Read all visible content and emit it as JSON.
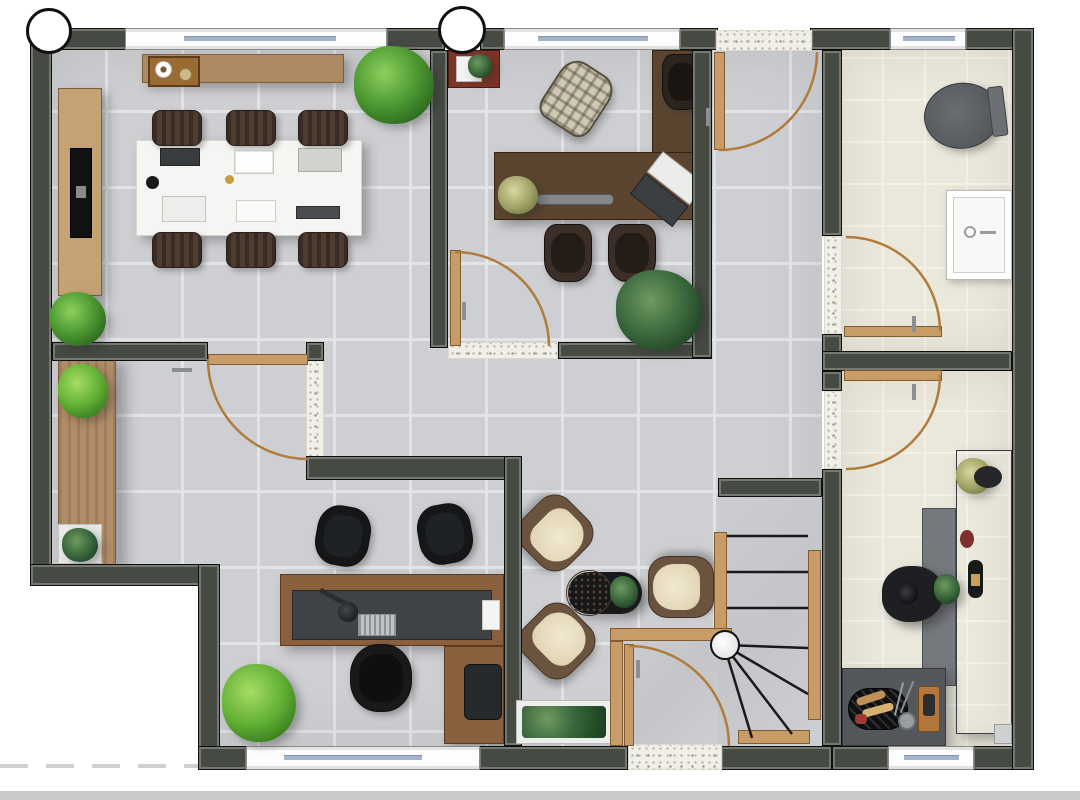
{
  "document": {
    "type": "architectural-floor-plan",
    "view": "top-down-rendered-3d",
    "width_px": 1080,
    "height_px": 800,
    "visible_text": "none"
  },
  "palette": {
    "wall": "#454a42",
    "wall_outline": "#0e100e",
    "gray_tile": "#cdcfd2",
    "gray_grout": "#e2e4e6",
    "beige_tile": "#eae7db",
    "concrete_stair": "#c8cacd",
    "threshold_speckle": "#f0efe8",
    "door_wood": "#c79c66",
    "door_arc": "#b07b3b",
    "bench_wood": "#b08d68",
    "conference_table": "#f5f5f3",
    "chair_brown": "#4f3c31",
    "chair_black": "#1a1c1e",
    "lounge_cream": "#e9dfc6",
    "lounge_frame": "#6b543f",
    "counter_dark": "#5a5e62",
    "toilet_gray": "#5b5f63",
    "fixture_white": "#f7f7f7",
    "plant_green": "#4e9a33",
    "plant_dark_green": "#2f5a33",
    "window_glass": "#a3b4ca",
    "grid_bubble_fill": "#ffffff"
  },
  "rooms": [
    {
      "id": "conference-room",
      "position": "north-west",
      "floor": "gray-tile",
      "furniture": [
        "wood sideboard with coffee tray",
        "wall tv console with tv",
        "white conference table",
        "six dark brown chairs",
        "laptops notebooks and papers on table",
        "corner potted plant",
        "corner ficus tree"
      ]
    },
    {
      "id": "executive-office",
      "position": "north-center",
      "floor": "gray-tile",
      "furniture": [
        "dark wood l-shaped desk",
        "desk speaker bar",
        "open laptop",
        "desk plant",
        "black executive chair",
        "rattan lounge chair",
        "two dark guest chairs",
        "monstera plant",
        "red side cabinet with plant"
      ]
    },
    {
      "id": "corridor",
      "position": "north-east-of-office",
      "floor": "gray-tile",
      "furniture": [
        "swing door at north speckled threshold"
      ]
    },
    {
      "id": "bathroom",
      "position": "north-east",
      "floor": "beige-tile",
      "furniture": [
        "gray toilet",
        "white washbasin with faucet"
      ]
    },
    {
      "id": "kitchen",
      "position": "east",
      "floor": "beige-tile",
      "furniture": [
        "l-shaped dark counter",
        "tall island counter",
        "person preparing food",
        "grill tray with food",
        "wooden cutting board",
        "flower bouquet",
        "bottle",
        "small pot"
      ]
    },
    {
      "id": "hallway",
      "position": "center",
      "floor": "gray-tile",
      "furniture": [
        "wooden bench along west wall",
        "potted plant on bench",
        "potted plant in white pot",
        "potted plant near office"
      ]
    },
    {
      "id": "lounge",
      "position": "center-south",
      "floor": "gray-tile",
      "furniture": [
        "three cream armchairs",
        "black oval coffee table",
        "round mosaic tray",
        "small table plant"
      ]
    },
    {
      "id": "office",
      "position": "south-west",
      "floor": "gray-tile",
      "furniture": [
        "l-shaped desk dark top wood frame",
        "desk lamp",
        "keyboard",
        "white document",
        "black office chair",
        "two black guest chairs",
        "dark file cabinet",
        "white planter box with greenery",
        "potted plant"
      ]
    },
    {
      "id": "staircase",
      "position": "south-center",
      "floor": "concrete",
      "furniture": [
        "three straight treads",
        "winder treads fanning from newel",
        "white newel circle",
        "timber stringers",
        "timber bottom tread"
      ]
    },
    {
      "id": "entry-vestibule",
      "position": "south",
      "floor": "concrete",
      "furniture": [
        "entry swing door",
        "speckled threshold",
        "timber corner trim"
      ]
    }
  ],
  "openings": {
    "windows": [
      {
        "location": "conference-room north wall"
      },
      {
        "location": "executive-office north wall"
      },
      {
        "location": "bathroom north wall"
      },
      {
        "location": "office south wall"
      },
      {
        "location": "kitchen south wall"
      }
    ],
    "doors": [
      {
        "room": "conference-room",
        "swing": "south into hallway"
      },
      {
        "room": "executive-office",
        "swing": "north into office"
      },
      {
        "room": "corridor",
        "swing": "south from north threshold"
      },
      {
        "room": "bathroom",
        "swing": "north into bathroom"
      },
      {
        "room": "kitchen",
        "swing": "south into kitchen"
      },
      {
        "room": "entry-vestibule",
        "swing": "east into vestibule"
      }
    ],
    "open_thresholds": 6
  },
  "annotations": {
    "grid_bubbles_top": 2,
    "stair_newel_circle": 1,
    "stair_type": "L-shaped winder",
    "dashed_property_line_bottom_left": true,
    "bottom_edge_strip": true
  }
}
